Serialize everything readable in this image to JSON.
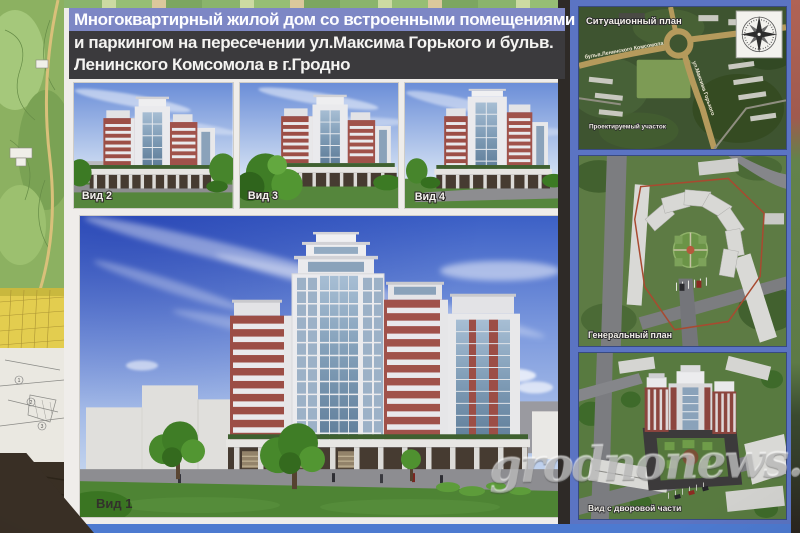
{
  "poster": {
    "title": {
      "line1": "Многоквартирный жилой дом со встроенными помещениями",
      "line2": "и паркингом на пересечении ул.Максима Горького и бульв.",
      "line3": "Ленинского Комсомола в г.Гродно"
    },
    "views": {
      "v1": "Вид 1",
      "v2": "Вид 2",
      "v3": "Вид 3",
      "v4": "Вид 4"
    },
    "panels": {
      "situational": {
        "title": "Ситуационный план",
        "street_boulevard": "бульв.Ленинского Комсомола",
        "street_gorky": "ул.Максима Горького",
        "site_label": "Проектируемый участок",
        "compass_icon": "compass-rose"
      },
      "general": {
        "title": "Генеральный план"
      },
      "yard": {
        "title": "Вид с дворовой части"
      }
    }
  },
  "background": {
    "cadastral_numbers": [
      "1",
      "2",
      "3"
    ]
  },
  "watermark": "grodnonews.by",
  "colors": {
    "title_highlight": "#7d87c5",
    "title_dark_bg": "#3b3a3d",
    "poster_white": "#efedea",
    "frame_blue": "#5b74c3",
    "bottom_strip_blue": "#4d7ad0",
    "divider_dark": "#2e2a27",
    "sky_deep_blue": "#3c60c6",
    "brick_red": "#9c4e46",
    "lawn_green": "#4e8434",
    "map_green": "#8cb161",
    "map_yellow": "#e3cd4f",
    "fabric_brown": "#392f25"
  }
}
